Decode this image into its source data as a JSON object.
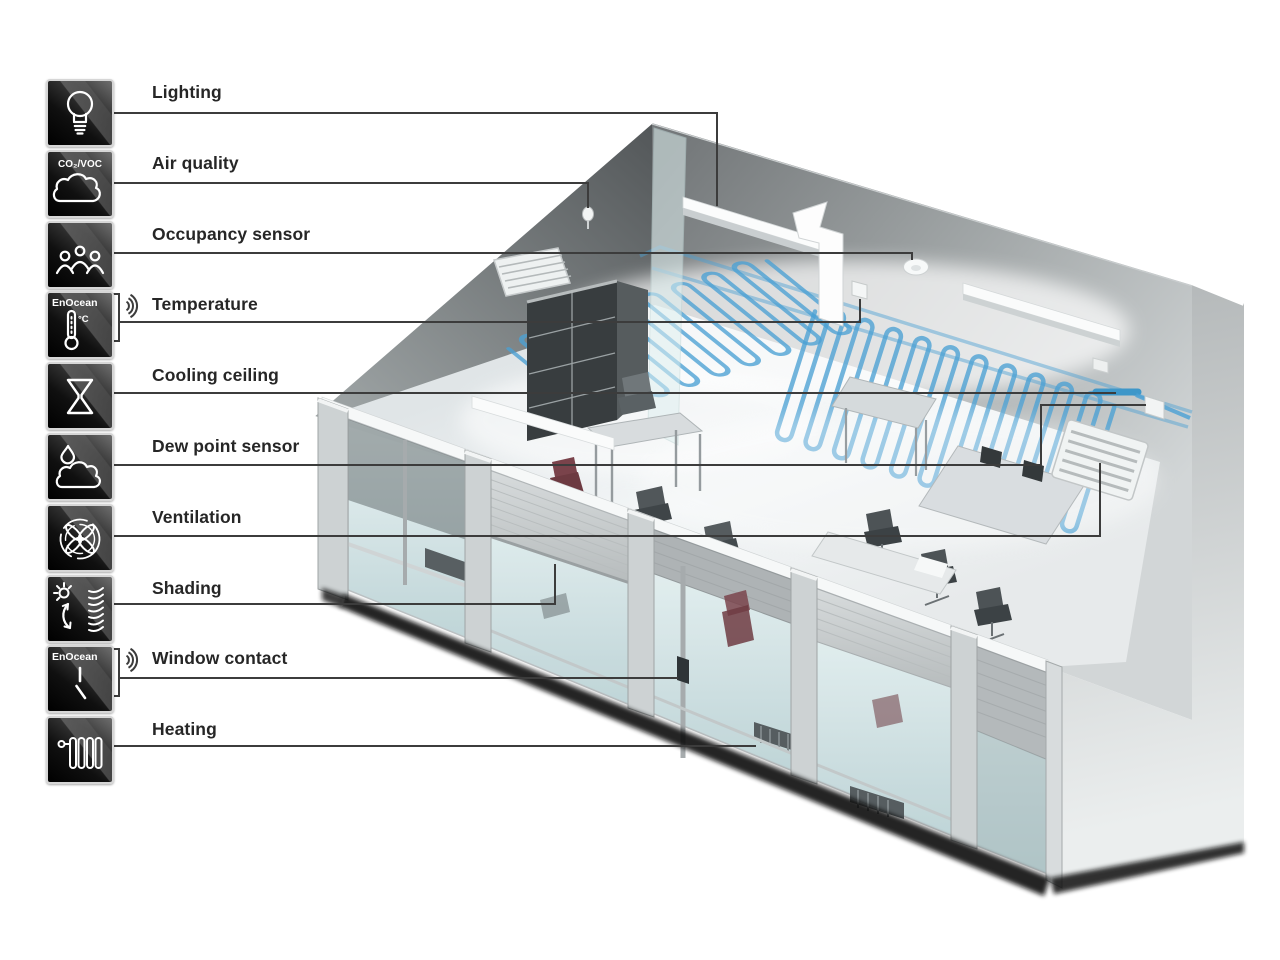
{
  "legend": {
    "items": [
      {
        "label": "Lighting",
        "icon": "light-bulb-icon"
      },
      {
        "label": "Air quality",
        "icon": "air-quality-cloud-icon",
        "badge": "CO₂/VOC"
      },
      {
        "label": "Occupancy sensor",
        "icon": "occupancy-people-icon"
      },
      {
        "label": "Temperature",
        "icon": "temperature-thermometer-icon",
        "badge": "EnOcean",
        "unit": "°C",
        "wireless": true
      },
      {
        "label": "Cooling ceiling",
        "icon": "cooling-ceiling-icon"
      },
      {
        "label": "Dew point sensor",
        "icon": "dew-point-icon"
      },
      {
        "label": "Ventilation",
        "icon": "ventilation-fan-icon"
      },
      {
        "label": "Shading",
        "icon": "shading-blinds-icon"
      },
      {
        "label": "Window contact",
        "icon": "window-contact-icon",
        "badge": "EnOcean",
        "wireless": true
      },
      {
        "label": "Heating",
        "icon": "heating-radiator-icon"
      }
    ]
  },
  "colors": {
    "pipe_blue": "#4AA0D4",
    "callout_line": "#3C3C3C",
    "label_text": "#262626",
    "tile_dark": "#0a0a0a"
  }
}
